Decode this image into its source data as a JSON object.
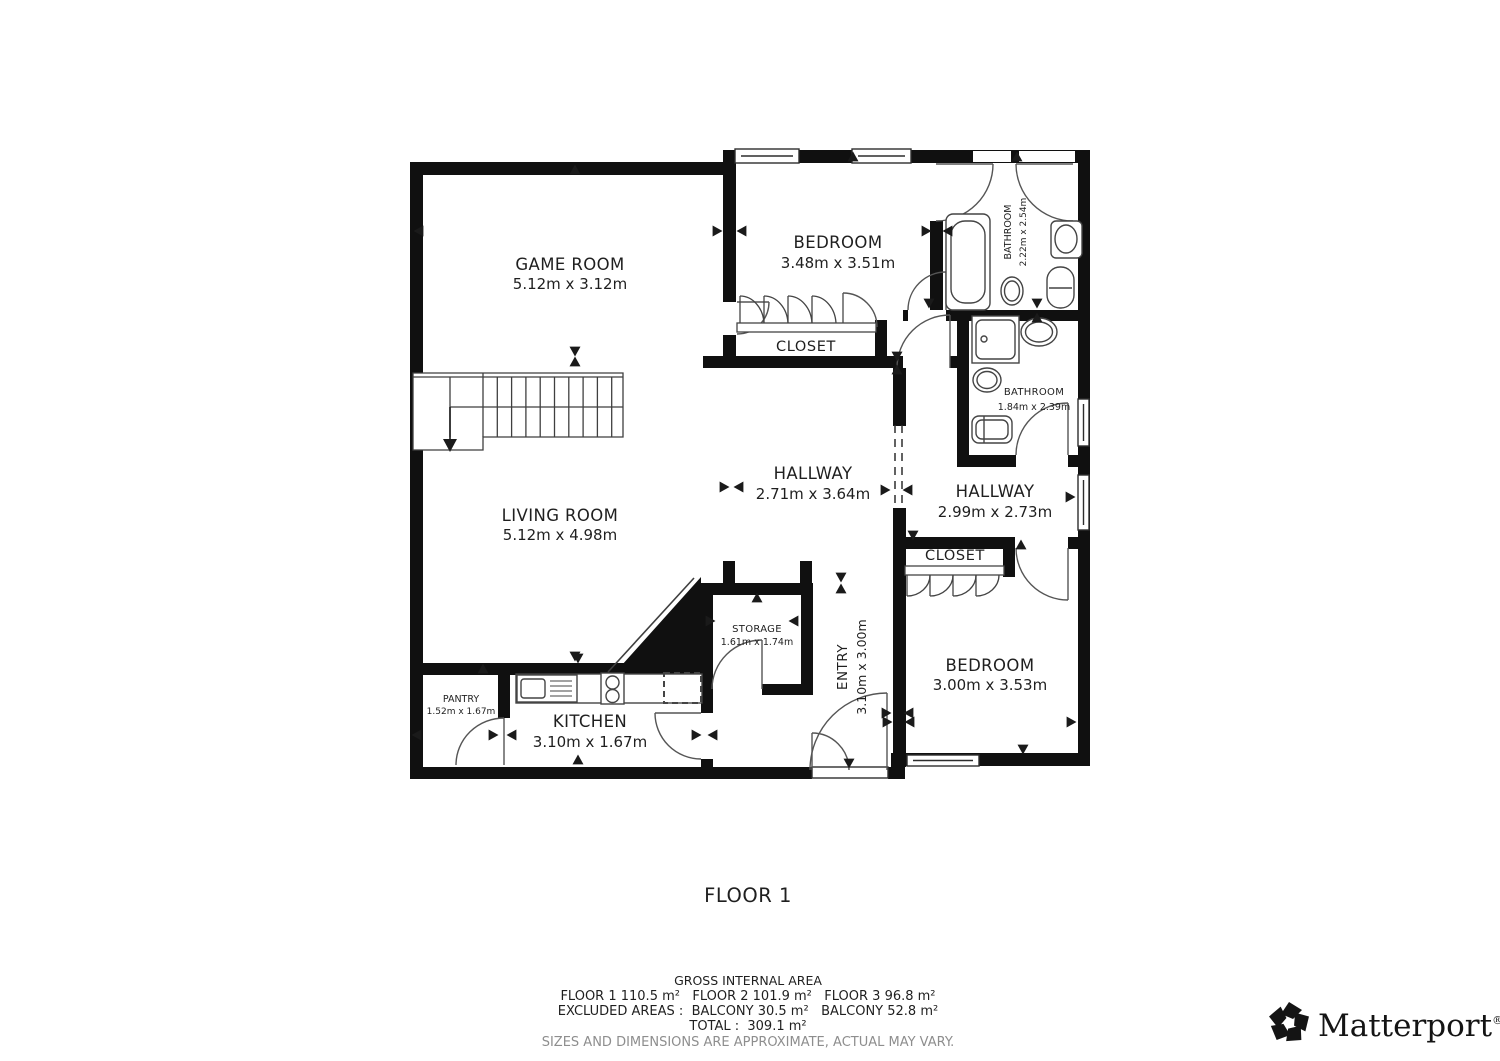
{
  "title": "FLOOR 1",
  "rooms": {
    "game_room": {
      "name": "GAME ROOM",
      "dims": "5.12m x 3.12m"
    },
    "bedroom_1": {
      "name": "BEDROOM",
      "dims": "3.48m x 3.51m"
    },
    "bathroom_1": {
      "name": "BATHROOM",
      "dims": "2.22m x 2.54m"
    },
    "closet_1": {
      "name": "CLOSET"
    },
    "living_room": {
      "name": "LIVING ROOM",
      "dims": "5.12m x 4.98m"
    },
    "hallway_1": {
      "name": "HALLWAY",
      "dims": "2.71m x 3.64m"
    },
    "bathroom_2": {
      "name": "BATHROOM",
      "dims": "1.84m x 2.39m"
    },
    "hallway_2": {
      "name": "HALLWAY",
      "dims": "2.99m x 2.73m"
    },
    "closet_2": {
      "name": "CLOSET"
    },
    "storage": {
      "name": "STORAGE",
      "dims": "1.61m x 1.74m"
    },
    "entry": {
      "name": "ENTRY",
      "dims": "3.10m x 3.00m"
    },
    "bedroom_2": {
      "name": "BEDROOM",
      "dims": "3.00m x 3.53m"
    },
    "pantry": {
      "name": "PANTRY",
      "dims": "1.52m x 1.67m"
    },
    "kitchen": {
      "name": "KITCHEN",
      "dims": "3.10m x 1.67m"
    }
  },
  "footer": {
    "heading": "GROSS INTERNAL AREA",
    "line_floors": "FLOOR 1 110.5 m²   FLOOR 2 101.9 m²   FLOOR 3 96.8 m²",
    "line_excluded": "EXCLUDED AREAS :  BALCONY 30.5 m²   BALCONY 52.8 m²",
    "line_total": "TOTAL :  309.1 m²",
    "disclaimer": "SIZES AND DIMENSIONS ARE APPROXIMATE, ACTUAL MAY VARY."
  },
  "brand": {
    "name": "Matterport",
    "reg": "®"
  },
  "colors": {
    "wall": "#101010",
    "line": "#4a4a4a",
    "text": "#1f1f1f",
    "muted": "#8e8e8e"
  }
}
